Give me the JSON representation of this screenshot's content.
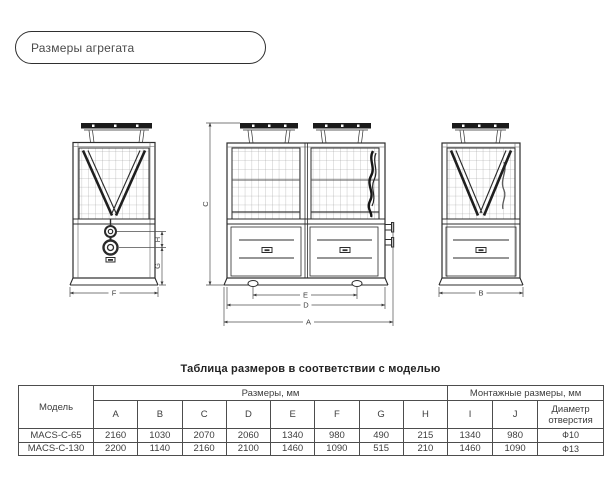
{
  "header": {
    "title": "Размеры агрегата"
  },
  "drawing": {
    "dims": {
      "A": "A",
      "B": "B",
      "C": "C",
      "D": "D",
      "E": "E",
      "F": "F",
      "G": "G",
      "H": "H"
    }
  },
  "table": {
    "title": "Таблица размеров в соответствии с моделью",
    "model_header": "Модель",
    "groups": {
      "dimensions": "Размеры, мм",
      "mounting": "Монтажные размеры, мм"
    },
    "columns": [
      "A",
      "B",
      "C",
      "D",
      "E",
      "F",
      "G",
      "H",
      "I",
      "J",
      "Диаметр отверстия"
    ],
    "rows": [
      {
        "model": "MACS-C-65",
        "values": [
          "2160",
          "1030",
          "2070",
          "2060",
          "1340",
          "980",
          "490",
          "215",
          "1340",
          "980",
          "Ф10"
        ]
      },
      {
        "model": "MACS-C-130",
        "values": [
          "2200",
          "1140",
          "2160",
          "2100",
          "1460",
          "1090",
          "515",
          "210",
          "1460",
          "1090",
          "Ф13"
        ]
      }
    ]
  }
}
